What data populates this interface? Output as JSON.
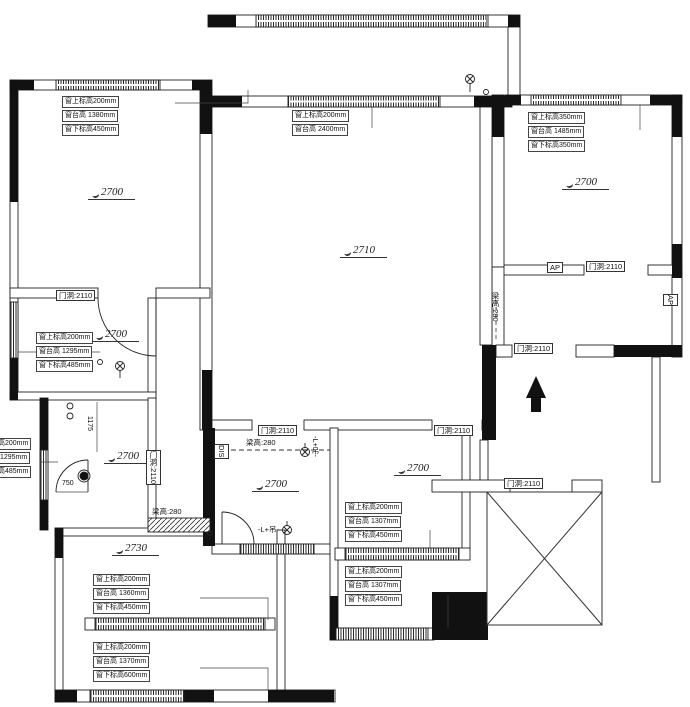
{
  "drawing": {
    "type": "residential floor plan (site measurement drawing)",
    "colors": {
      "wall": "#111111",
      "line": "#333333",
      "background": "#ffffff"
    }
  },
  "room_heights": {
    "top_left_bedroom": "2700",
    "living_room": "2710",
    "top_right_bedroom": "2700",
    "mid_left_room": "2700",
    "lower_left_room": "2700",
    "bottom_left_room": "2730",
    "bottom_mid_small_room": "2700",
    "bottom_mid_room": "2700"
  },
  "window_annotations": {
    "top_left": {
      "l1": "窗上标高200mm",
      "l2": "窗台高 1380mm",
      "l3": "窗下标高450mm"
    },
    "living_top": {
      "l1": "窗上标高200mm",
      "l2": "窗台高 2400mm"
    },
    "top_right": {
      "l1": "窗上标高350mm",
      "l2": "窗台高 1485mm",
      "l3": "窗下标高350mm"
    },
    "mid_left": {
      "l1": "窗上标高200mm",
      "l2": "窗台高 1295mm",
      "l3": "窗下标高485mm"
    },
    "left_edge": {
      "l1": "窗上标高200mm",
      "l2": "窗台高 1295mm",
      "l3": "窗下标高485mm"
    },
    "bottom_left_upper": {
      "l1": "窗上标高200mm",
      "l2": "窗台高 1360mm",
      "l3": "窗下标高450mm"
    },
    "bottom_left_lower": {
      "l1": "窗上标高200mm",
      "l2": "窗台高 1370mm",
      "l3": "窗下标高600mm"
    },
    "bottom_mid_upper": {
      "l1": "窗上标高200mm",
      "l2": "窗台高 1307mm",
      "l3": "窗下标高450mm"
    },
    "bottom_mid_lower": {
      "l1": "窗上标高200mm",
      "l2": "窗台高 1307mm",
      "l3": "窗下标高450mm"
    }
  },
  "door_labels": {
    "d1": "门洞:2110",
    "d2": "门洞:2110",
    "d3": "门洞:2110",
    "d4": "门洞:2110",
    "d5": "门洞:2110",
    "d6": "门洞:2110",
    "d7": "门洞:2110"
  },
  "beam_labels": {
    "b1": "梁高:280",
    "b2": "梁高:280",
    "b3": "梁高:280"
  },
  "panel_labels": {
    "ap_top": "AP",
    "ap_right": "AP",
    "dis": "DIS"
  },
  "light_labels": {
    "small_room_side": "-L+吊-",
    "small_room_bottom": "-L+吊-"
  },
  "dimensions": {
    "v1175": "1175",
    "h750": "750"
  }
}
